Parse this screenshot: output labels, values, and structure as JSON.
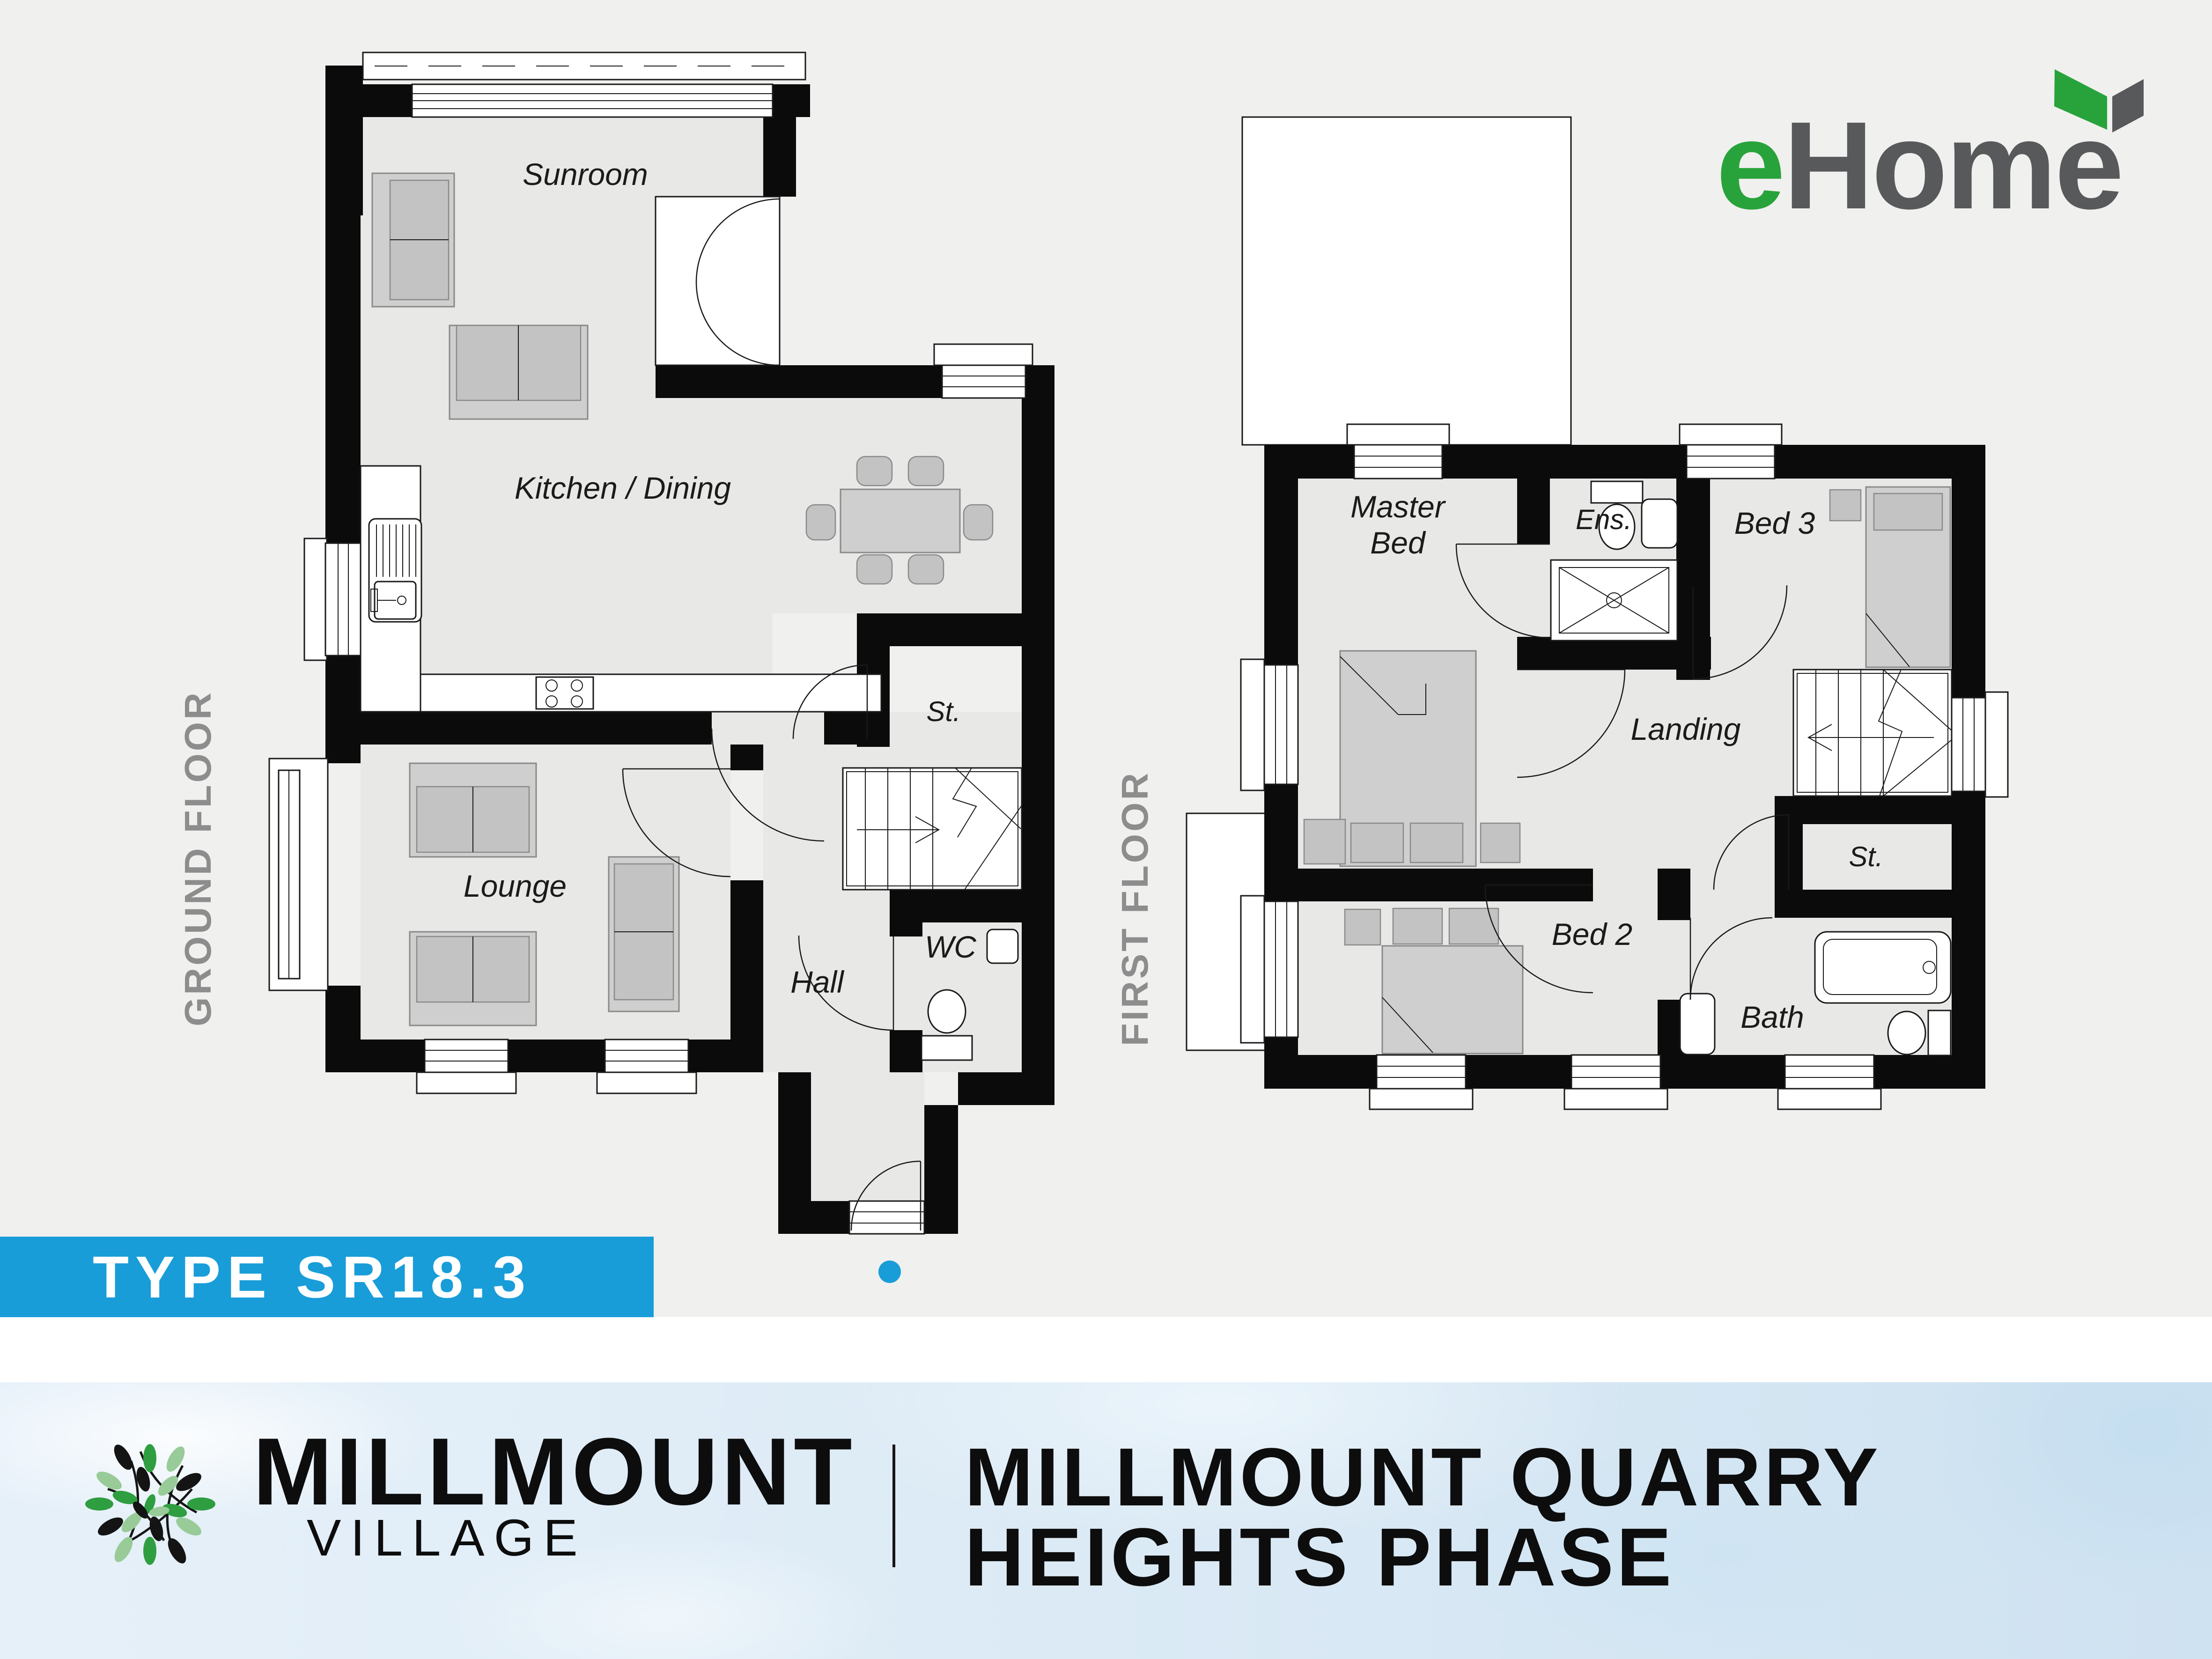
{
  "colors": {
    "background": "#f0f0ef",
    "plan_floor": "#e8e8e7",
    "wall": "#0b0b0b",
    "accent_blue": "#189dd9",
    "ehome_green": "#28a33b",
    "ehome_gray": "#58595b",
    "floor_label_gray": "#8d8d8d",
    "watercolor_blue": "#dceaf6"
  },
  "ehome_logo": {
    "e": "e",
    "home": "Home"
  },
  "type_banner": {
    "label": "TYPE SR18.3"
  },
  "floors": {
    "ground": {
      "label": "GROUND FLOOR",
      "rooms": {
        "sunroom": "Sunroom",
        "kitchen_dining": "Kitchen / Dining",
        "storage": "St.",
        "lounge": "Lounge",
        "hall": "Hall",
        "wc": "WC"
      }
    },
    "first": {
      "label": "FIRST FLOOR",
      "rooms": {
        "master_bed": [
          "Master",
          "Bed"
        ],
        "ensuite": "Ens.",
        "bed3": "Bed 3",
        "landing": "Landing",
        "storage": "St.",
        "bed2": "Bed 2",
        "bath": "Bath"
      }
    }
  },
  "footer": {
    "brand_name": "MILLMOUNT",
    "brand_subtitle": "VILLAGE",
    "development_name": [
      "MILLMOUNT QUARRY",
      "HEIGHTS PHASE"
    ]
  }
}
